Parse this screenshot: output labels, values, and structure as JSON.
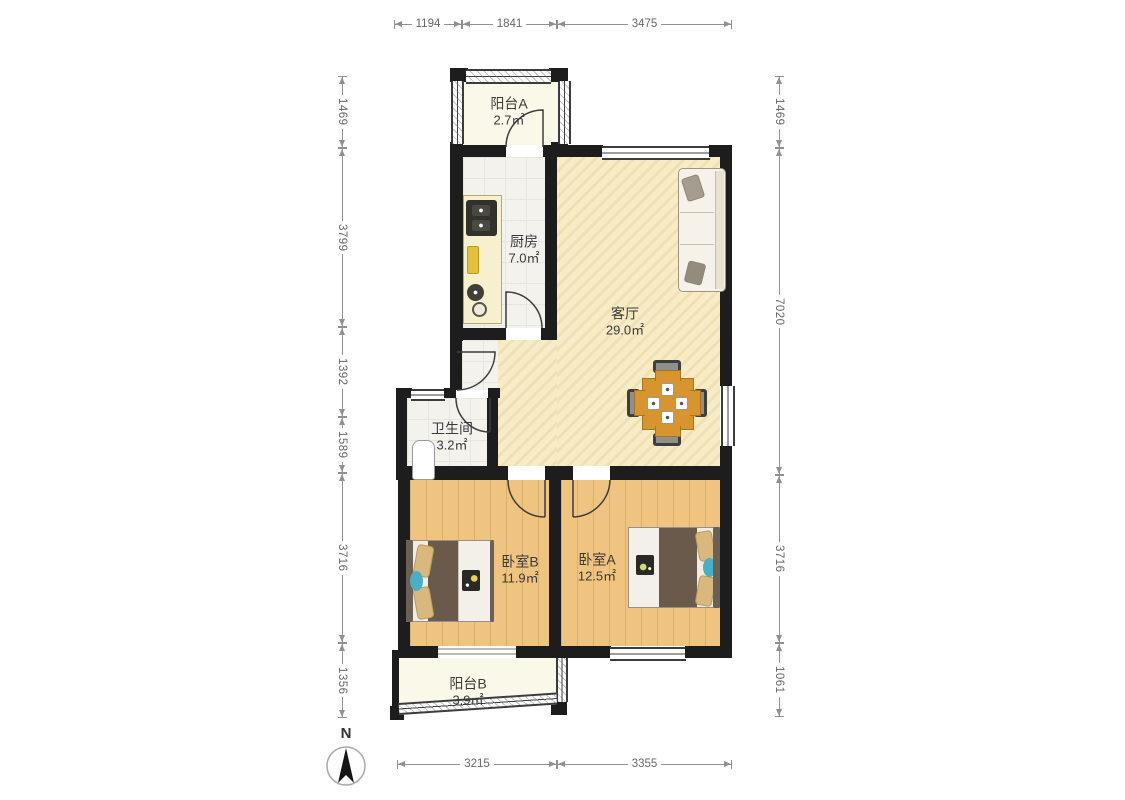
{
  "floorplan": {
    "north_label": "N",
    "rooms": [
      {
        "name": "阳台A",
        "area": "2.7㎡"
      },
      {
        "name": "厨房",
        "area": "7.0㎡"
      },
      {
        "name": "客厅",
        "area": "29.0㎡"
      },
      {
        "name": "卫生间",
        "area": "3.2㎡"
      },
      {
        "name": "卧室B",
        "area": "11.9㎡"
      },
      {
        "name": "卧室A",
        "area": "12.5㎡"
      },
      {
        "name": "阳台B",
        "area": "3.9㎡"
      }
    ],
    "dimensions_mm": {
      "top": [
        "1194",
        "1841",
        "3475"
      ],
      "bottom": [
        "3215",
        "3355"
      ],
      "left": [
        "1469",
        "3799",
        "1392",
        "1589",
        "3716",
        "1356"
      ],
      "right": [
        "1469",
        "7020",
        "3716",
        "1061"
      ]
    }
  }
}
